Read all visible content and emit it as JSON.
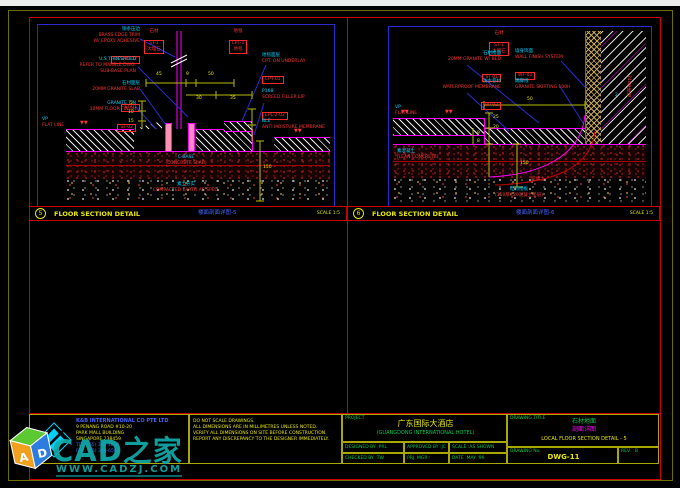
{
  "bars": [
    {
      "num": "5",
      "title": "FLOOR SECTION DETAIL",
      "cn": "楼面剖面详图-5",
      "scale": "SCALE 1:5"
    },
    {
      "num": "6",
      "title": "FLOOR SECTION DETAIL",
      "cn": "楼面剖面详图-6",
      "scale": "SCALE 1:5"
    }
  ],
  "d5": {
    "tags": [
      {
        "cap": "石材",
        "l1": "ST-1",
        "l2": "大理石"
      },
      {
        "cap": "地毯",
        "l1": "CPT-1",
        "l2": "地毯"
      }
    ],
    "left": [
      {
        "head": "铜条压边",
        "l1": "BRASS EDGE TRIM",
        "l2": "W/ EPOXY ADHESIVE",
        "box": "DETAIL 02"
      },
      {
        "head": "U.S THRESHOLD",
        "l1": "REFER TO MARBLE DWG.",
        "l2": "SUB-BASE PLAN"
      },
      {
        "head": "石材面层",
        "l1": "20MM GRANITE SLAB",
        "box": "ST-01"
      },
      {
        "head": "GRANITE T/N",
        "l1": "10MM FLOOR FINISH",
        "box": "ST-02"
      },
      {
        "head": "VP",
        "l1": "FLAT LINE"
      }
    ],
    "right": [
      {
        "head": "地毯面层",
        "l1": "CPT. ON UNDERLAY",
        "box": "CPT-01"
      },
      {
        "head": "P168",
        "l1": "SCREED FILLER LIP",
        "box": "EPL-2-02"
      },
      {
        "head": "BLE",
        "l1": "ANTI MOISTURE MEMBRANE"
      }
    ],
    "center_head": "C-BASE",
    "center_line": "(CONCRETE SLAB)",
    "bottom_head": "素土夯实",
    "bottom_line": "COMPACTED EARTH AS SPEC.",
    "dims": {
      "t0": "45",
      "t1": "9",
      "t2": "50",
      "m0": "30",
      "m1": "35",
      "v0": "5",
      "v1": "10",
      "v2": "15",
      "deep": "150"
    },
    "marks": "▼▼"
  },
  "d6": {
    "tag": {
      "cap": "石材",
      "l1": "ST-1",
      "l2": "大理石"
    },
    "left": [
      {
        "head": "石材楼面",
        "l1": "20MM GRANITE W/ BED",
        "box": "ST-01"
      },
      {
        "head": "防水卷材",
        "l1": "WATERPROOF MEMBRANE",
        "box": "WP-02"
      },
      {
        "head": "VP",
        "l1": "FLAT LINE"
      }
    ],
    "right": [
      {
        "head": "墙身饰面",
        "l1": "WALL FINISH SYSTEM",
        "box": "WF-01"
      },
      {
        "head": "踢脚线",
        "l1": "GRANITE SKIRTING 100H"
      }
    ],
    "wall_text": "240厚砖墙",
    "wall_num": "2",
    "lean_head": "素混凝土",
    "lean_line": "(LEAN CONCRETE)",
    "fill_text": "回填土",
    "bottom_head": "结构楼板",
    "bottom_line": "(150厚C20混凝土垫层)",
    "dims": {
      "t0": "50",
      "a": "25",
      "b": "20",
      "c": "9",
      "d": "8",
      "deep": "150"
    },
    "marks": "▼▼"
  },
  "block": {
    "company": {
      "name": "K&B INTERNATIONAL CO PTE LTD",
      "a1": "9 PENANG ROAD #10-20",
      "a2": "PARK MALL BUILDING",
      "a3": "SINGAPORE 238459",
      "t1": "TEL: (65) 336-3633",
      "t2": "FAX: (65) 339-6500"
    },
    "notes": [
      "DO NOT SCALE DRAWINGS.",
      "ALL DIMENSIONS ARE IN MILLIMETRES UNLESS NOTED.",
      "VERIFY ALL DIMENSIONS ON SITE BEFORE CONSTRUCTION.",
      "REPORT ANY DISCREPANCY TO THE DESIGNER IMMEDIATELY."
    ],
    "project": {
      "label": "PROJECT",
      "cn": "广东国际大酒店",
      "en": "(GUANGDONG INTERNATIONAL HOTEL)"
    },
    "fields": [
      {
        "k": "DESIGNED BY",
        "v": "PRL"
      },
      {
        "k": "APPROVED BY",
        "v": "JC"
      },
      {
        "k": "SCALE",
        "v": "AS SHOWN"
      },
      {
        "k": "CHECKED BY",
        "v": "TW"
      },
      {
        "k": "PRJ. MGR",
        "v": ""
      },
      {
        "k": "DATE",
        "v": "MAY '99"
      }
    ],
    "drawing": {
      "label": "DRAWING TITLE",
      "cn1": "石材地面",
      "cn2": "剖面详图",
      "en": "LOCAL FLOOR SECTION DETAIL - 5",
      "no_label": "DRAWING No.",
      "no": "DWG-11",
      "rev_label": "REV",
      "rev": "B"
    }
  },
  "watermark": {
    "brand": "CAD之家",
    "url": "WWW.CADZJ.COM",
    "cube_a": "A",
    "cube_d": "D"
  }
}
